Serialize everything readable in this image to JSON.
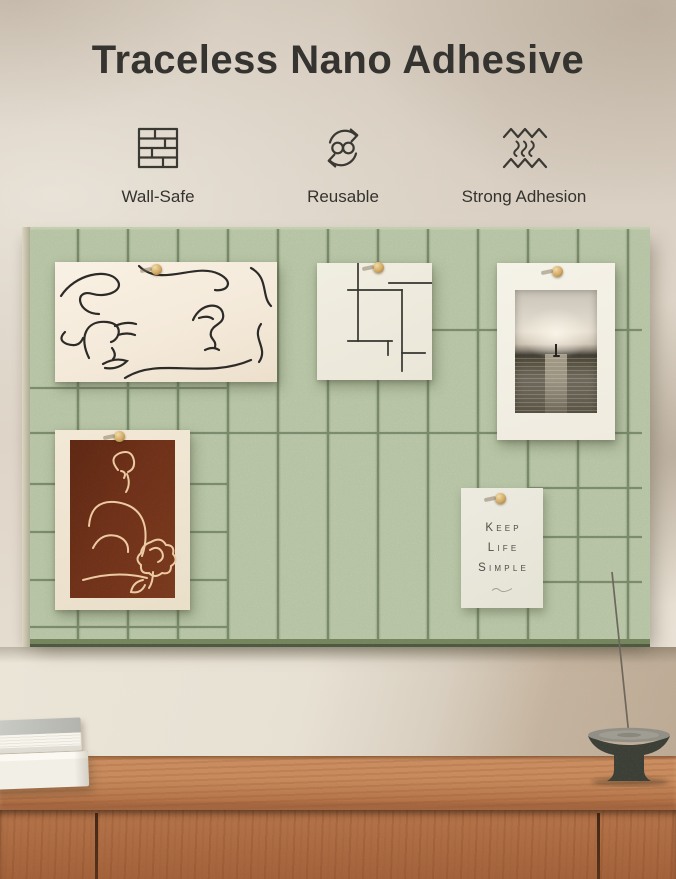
{
  "header": {
    "title": "Traceless Nano Adhesive",
    "features": [
      {
        "label": "Wall-Safe",
        "icon": "brick-wall-icon"
      },
      {
        "label": "Reusable",
        "icon": "reusable-cycle-icon"
      },
      {
        "label": "Strong Adhesion",
        "icon": "adhesion-heat-waves-icon"
      }
    ]
  },
  "board": {
    "quote_card": {
      "lines": [
        "Keep",
        "Life",
        "Simple"
      ]
    }
  },
  "colors": {
    "wall_beige": "#d6cbbe",
    "wall_plaster": "#e7e1d5",
    "felt_green": "#b6c3a4",
    "felt_groove": "#6e8059",
    "title_text": "#353330",
    "icon_stroke": "#3a3833",
    "poster_cream": "#f4ecdf",
    "poster_rust": "#6f3119",
    "line_art_dark": "#2b2a27",
    "line_art_cream": "#eccaa2",
    "card_bg": "#eae8dc",
    "pin_wood": "#caa05e",
    "wood_top": "#c5875a",
    "wood_front": "#aa6a41",
    "stone_bowl": "#3e4138"
  }
}
